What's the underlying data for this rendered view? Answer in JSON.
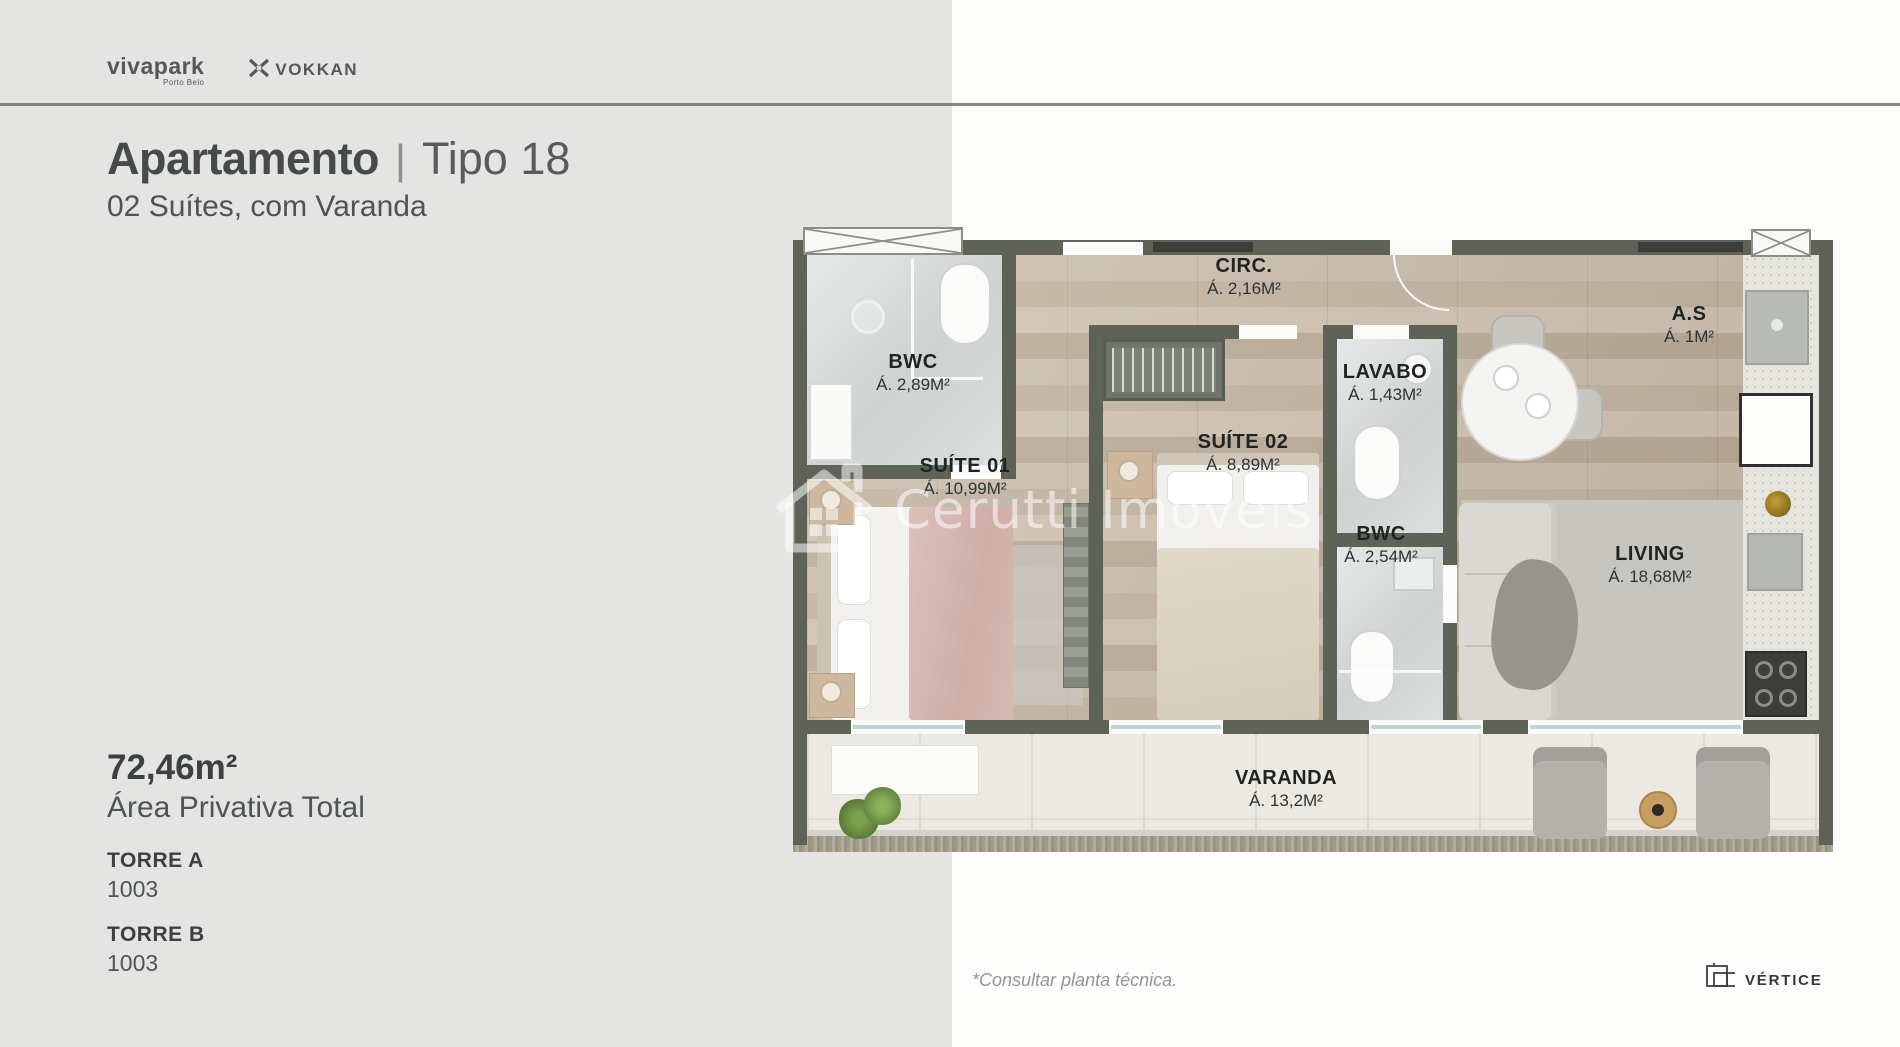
{
  "brand": {
    "vivapark_label": "vivapark",
    "vivapark_sub": "Porto Belo",
    "vokkan_label": "VOKKAN"
  },
  "header": {
    "title_bold": "Apartamento",
    "title_sep": "|",
    "title_light": "Tipo 18",
    "subtitle": "02 Suítes, com Varanda"
  },
  "details": {
    "area_value": "72,46m²",
    "area_label": "Área Privativa Total",
    "towers": [
      {
        "name": "TORRE A",
        "unit": "1003"
      },
      {
        "name": "TORRE B",
        "unit": "1003"
      }
    ]
  },
  "floorplan": {
    "watermark": "Cerutti Imóveis",
    "rooms": [
      {
        "name": "BWC",
        "area": "Á. 2,89M²"
      },
      {
        "name": "CIRC.",
        "area": "Á. 2,16M²"
      },
      {
        "name": "A.S",
        "area": "Á. 1M²"
      },
      {
        "name": "LAVABO",
        "area": "Á. 1,43M²"
      },
      {
        "name": "SUÍTE 01",
        "area": "Á. 10,99M²"
      },
      {
        "name": "SUÍTE 02",
        "area": "Á. 8,89M²"
      },
      {
        "name": "BWC",
        "area": "Á. 2,54M²"
      },
      {
        "name": "LIVING",
        "area": "Á. 18,68M²"
      },
      {
        "name": "VARANDA",
        "area": "Á. 13,2M²"
      }
    ]
  },
  "footer": {
    "note": "*Consultar planta técnica.",
    "vertice_label": "VÉRTICE"
  },
  "colors": {
    "left_background": "#e4e4e2",
    "right_background": "#fdfdfc",
    "wall": "#5e6257",
    "wood_floor": "#c3b4a1",
    "title_text": "#454b4b",
    "accent_pink_blanket": "#d7b8b2"
  }
}
